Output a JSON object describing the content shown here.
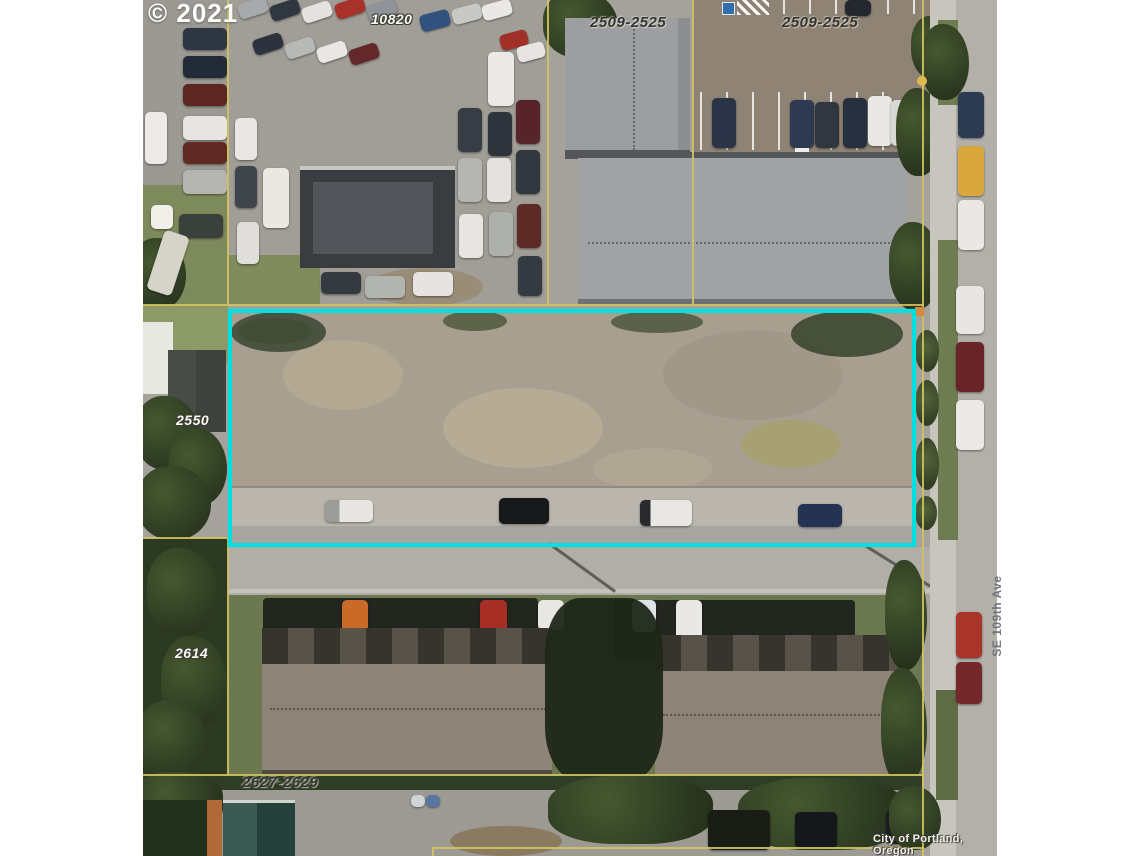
{
  "map": {
    "copyright": "© 2021",
    "attribution": "City of Portland, Oregon",
    "street": "SE 109th Ave",
    "labels": {
      "lot_10820": "10820",
      "lot_2509_left": "2509-2525",
      "lot_2509_right": "2509-2525",
      "lot_2550": "2550",
      "lot_2614": "2614",
      "lot_2627": "2627-2629"
    },
    "colors": {
      "highlight_outline": "#00dfe2",
      "parcel_line": "#d2c362",
      "background_margin": "#ffffff"
    }
  }
}
